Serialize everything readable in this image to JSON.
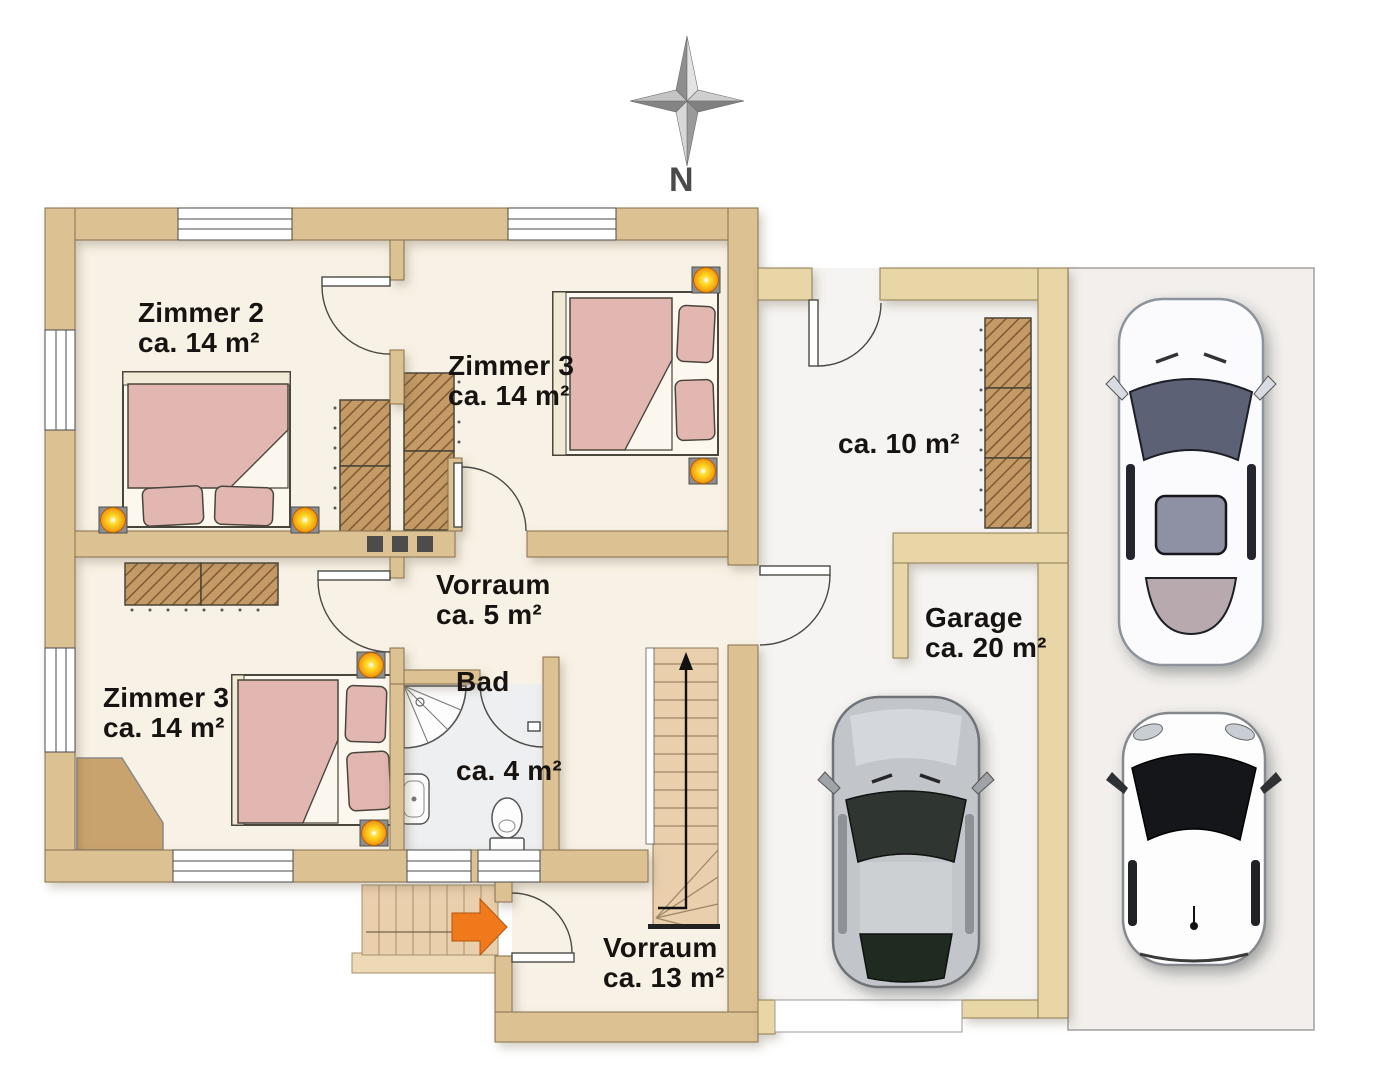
{
  "compass": {
    "label": "N"
  },
  "rooms": {
    "zimmer2": {
      "name": "Zimmer 2",
      "area": "ca. 14 m²"
    },
    "zimmer3_top": {
      "name": "Zimmer 3",
      "area": "ca. 14 m²"
    },
    "zimmer3_bottom": {
      "name": "Zimmer 3",
      "area": "ca. 14 m²"
    },
    "vorraum_upper": {
      "name": "Vorraum",
      "area": "ca. 5 m²"
    },
    "bad": {
      "name": "Bad",
      "area": "ca. 4 m²"
    },
    "vorraum_lower": {
      "name": "Vorraum",
      "area": "ca. 13 m²"
    },
    "garage": {
      "name": "Garage",
      "area": "ca. 20 m²"
    },
    "storage": {
      "area": "ca. 10 m²"
    }
  },
  "colors": {
    "wall_main": "#dcc193",
    "wall_wing": "#e8d6a7",
    "floor_cream": "#f8f2e6",
    "floor_bath": "#edeff1",
    "floor_wing": "#f6f4f2",
    "driveway": "#f2efec",
    "bed_pink": "#e2b6b1",
    "wardrobe_brown": "#c49a66",
    "lamp_yellow": "#ffd21c",
    "entrance_arrow": "#f0791b",
    "stairs_tan": "#e9cfac"
  },
  "icons": {
    "compass_rose": "compass-rose-icon",
    "entrance_arrow": "entrance-arrow-icon",
    "stairs_arrow": "stairs-direction-arrow-icon"
  }
}
